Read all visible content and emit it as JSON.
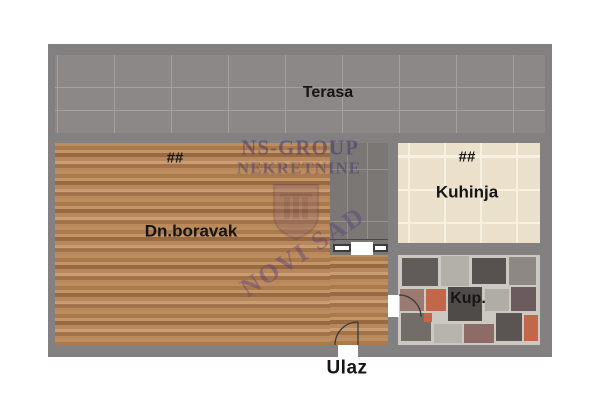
{
  "plan": {
    "rooms": {
      "terrace": {
        "label": "Terasa"
      },
      "living": {
        "label": "Dn.boravak",
        "marker": "##"
      },
      "kitchen": {
        "label": "Kuhinja",
        "marker": "##"
      },
      "bathroom": {
        "label": "Kup."
      },
      "entrance": {
        "label": "Ulaz"
      }
    },
    "watermark": {
      "line1": "NS-GROUP",
      "line2": "NEKRETNINE",
      "city": "NOVI SAD"
    },
    "colors": {
      "wall_grey": "#828080",
      "terrace_tile": "#8b8887",
      "hallway_tile": "#7b7774",
      "wood_floor": "#b5835a",
      "kitchen_tile": "#eae0cb",
      "bathroom_grout": "#ccc8c2",
      "watermark_purple": "#3e3270",
      "door_line": "#3b3b3b"
    },
    "bathroom_tiles": [
      {
        "x": 4,
        "y": 3,
        "w": 36,
        "h": 28,
        "c": "#615c59"
      },
      {
        "x": 43,
        "y": 1,
        "w": 28,
        "h": 30,
        "c": "#b3b0a9"
      },
      {
        "x": 74,
        "y": 3,
        "w": 34,
        "h": 26,
        "c": "#575250"
      },
      {
        "x": 111,
        "y": 2,
        "w": 27,
        "h": 28,
        "c": "#8d8883"
      },
      {
        "x": 2,
        "y": 34,
        "w": 24,
        "h": 22,
        "c": "#9b7a72"
      },
      {
        "x": 28,
        "y": 34,
        "w": 20,
        "h": 22,
        "c": "#c2674a"
      },
      {
        "x": 50,
        "y": 32,
        "w": 34,
        "h": 34,
        "c": "#4f4b49"
      },
      {
        "x": 87,
        "y": 34,
        "w": 24,
        "h": 22,
        "c": "#b0ada6"
      },
      {
        "x": 113,
        "y": 32,
        "w": 25,
        "h": 24,
        "c": "#6b5a5e"
      },
      {
        "x": 3,
        "y": 58,
        "w": 30,
        "h": 28,
        "c": "#726d69"
      },
      {
        "x": 36,
        "y": 69,
        "w": 28,
        "h": 19,
        "c": "#b7b4ad"
      },
      {
        "x": 66,
        "y": 69,
        "w": 30,
        "h": 19,
        "c": "#8d6b66"
      },
      {
        "x": 98,
        "y": 58,
        "w": 26,
        "h": 28,
        "c": "#5a5553"
      },
      {
        "x": 126,
        "y": 60,
        "w": 14,
        "h": 26,
        "c": "#c2674a"
      },
      {
        "x": 26,
        "y": 58,
        "w": 8,
        "h": 9,
        "c": "#c2674a"
      }
    ]
  }
}
